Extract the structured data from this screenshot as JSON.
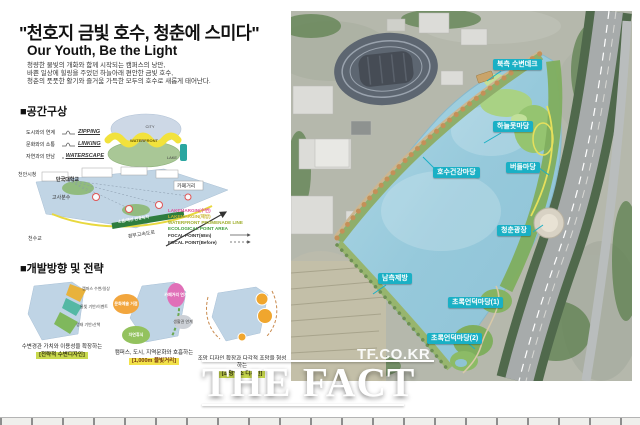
{
  "header": {
    "title": "\"천호지 금빛 호수, 청춘에 스미다\"",
    "subtitle": "Our Youth, Be the Light",
    "desc1": "청량한 물빛의 개화와 함께 시작되는 캠퍼스의 낭만,",
    "desc2": "바쁜 일상에 힐링을 주었던 하늘아래 편안한 금빛 호수,",
    "desc3": "청춘의 풋풋한 활기와 즐거움 가득한 모두의 호수로 새롭게 태어난다."
  },
  "concept": {
    "heading": "■공간구상",
    "rows": [
      {
        "label": "도시와의 연계",
        "keyword": "ZIPPING"
      },
      {
        "label": "문화와의 소통",
        "keyword": "LINKING"
      },
      {
        "label": "자연과의 만남",
        "keyword": "WATERSCAPE"
      }
    ],
    "blob": {
      "top": "CITY",
      "mid": "WATERFRONT",
      "bottom": "LAKE"
    }
  },
  "site": {
    "labels": {
      "cityhall": "천안시청",
      "university": "단국대학교",
      "fountain": "고사분수",
      "cafe": "카페거리",
      "bridge": "천수교",
      "expressway": "경부고속도로",
      "buffer": "소음/매연 완충녹지"
    },
    "legend": [
      {
        "text": "LAKEMARGIN(수변)",
        "style": "fill:#e0519a"
      },
      {
        "text": "LAKEMARGIN(제방)",
        "style": "fill:#c9b42e"
      },
      {
        "text": "WATERFRONT PROMENADE LINE",
        "style": "fill:#9fae2c"
      },
      {
        "text": "ECOLOGICAL POINT AREA",
        "style": "fill:#3f9e3a"
      },
      {
        "text": "FOCAL POINT(68m)",
        "style": "fill:#333333"
      },
      {
        "text": "FOCAL POINT(Before)",
        "style": "fill:#333333"
      }
    ]
  },
  "strategy": {
    "heading": "■개발방향 및 전략",
    "items": [
      {
        "caption": "수변경관 가치와 이용성을 확장하는",
        "highlight": "[전략적 수변디자인]",
        "zones": [
          "캠퍼스 수변/일상",
          "물빛 기반/이벤트",
          "생태 기반/산책"
        ]
      },
      {
        "caption": "캠퍼스, 도시, 지역문화와 호흡하는",
        "highlight": "[1,000m 물빛거리]",
        "zones": [
          "문화예술 거점",
          "카페거리 연계",
          "생활권 연계",
          "자연휴식"
        ]
      },
      {
        "caption": "조망 디자인 확장과 다각적 조망을 형성하는",
        "highlight": "[조망명소 디자인]"
      }
    ]
  },
  "map": {
    "labels": [
      {
        "text": "북측 수변데크"
      },
      {
        "text": "하늘못마당"
      },
      {
        "text": "버들마당"
      },
      {
        "text": "호수건강마당"
      },
      {
        "text": "청춘광장"
      },
      {
        "text": "남측제방"
      },
      {
        "text": "초록언덕마당(1)"
      },
      {
        "text": "초록언덕마당(2)"
      }
    ],
    "watermark": "TF.CO.KR"
  },
  "branding": {
    "logo": "THE FACT"
  },
  "colors": {
    "label_teal": "#1ab0c5",
    "water": "#9ccbdc",
    "shore_green": "#7fae5e",
    "tree_tan": "#c49058"
  }
}
